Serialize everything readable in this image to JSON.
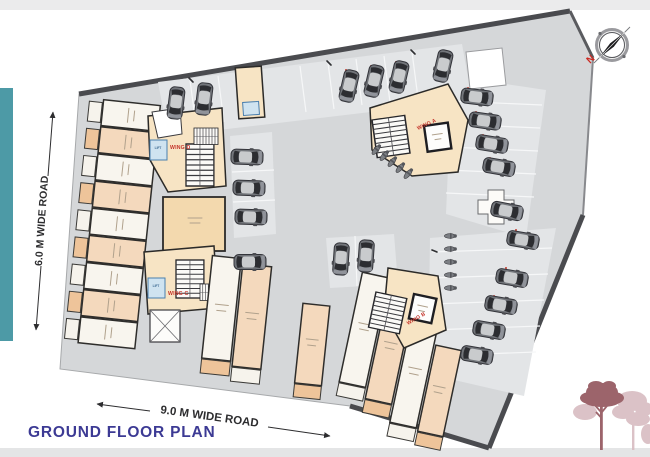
{
  "plan": {
    "title": "GROUND FLOOR PLAN"
  },
  "roads": {
    "left": "6.0 M WIDE ROAD",
    "bottom": "9.0 M WIDE ROAD"
  },
  "compass": {
    "north": "N"
  },
  "wings": {
    "a": "WING A",
    "b": "WING B",
    "c": "WING C",
    "d": "WING D"
  },
  "rooms": {
    "lift": "LIFT"
  },
  "colors": {
    "accent_teal": "#4d9aa6",
    "title_navy": "#3c3a94",
    "wing_label_red": "#c5342a",
    "site_gray": "#d5d7d9",
    "unit_peach": "#f4d9bd",
    "unit_white": "#f8f5ee",
    "core_tan": "#f7e4c4",
    "lift_blue": "#cfe3f0",
    "tree_dark": "#9c646b",
    "tree_light": "#d8bcc1"
  }
}
